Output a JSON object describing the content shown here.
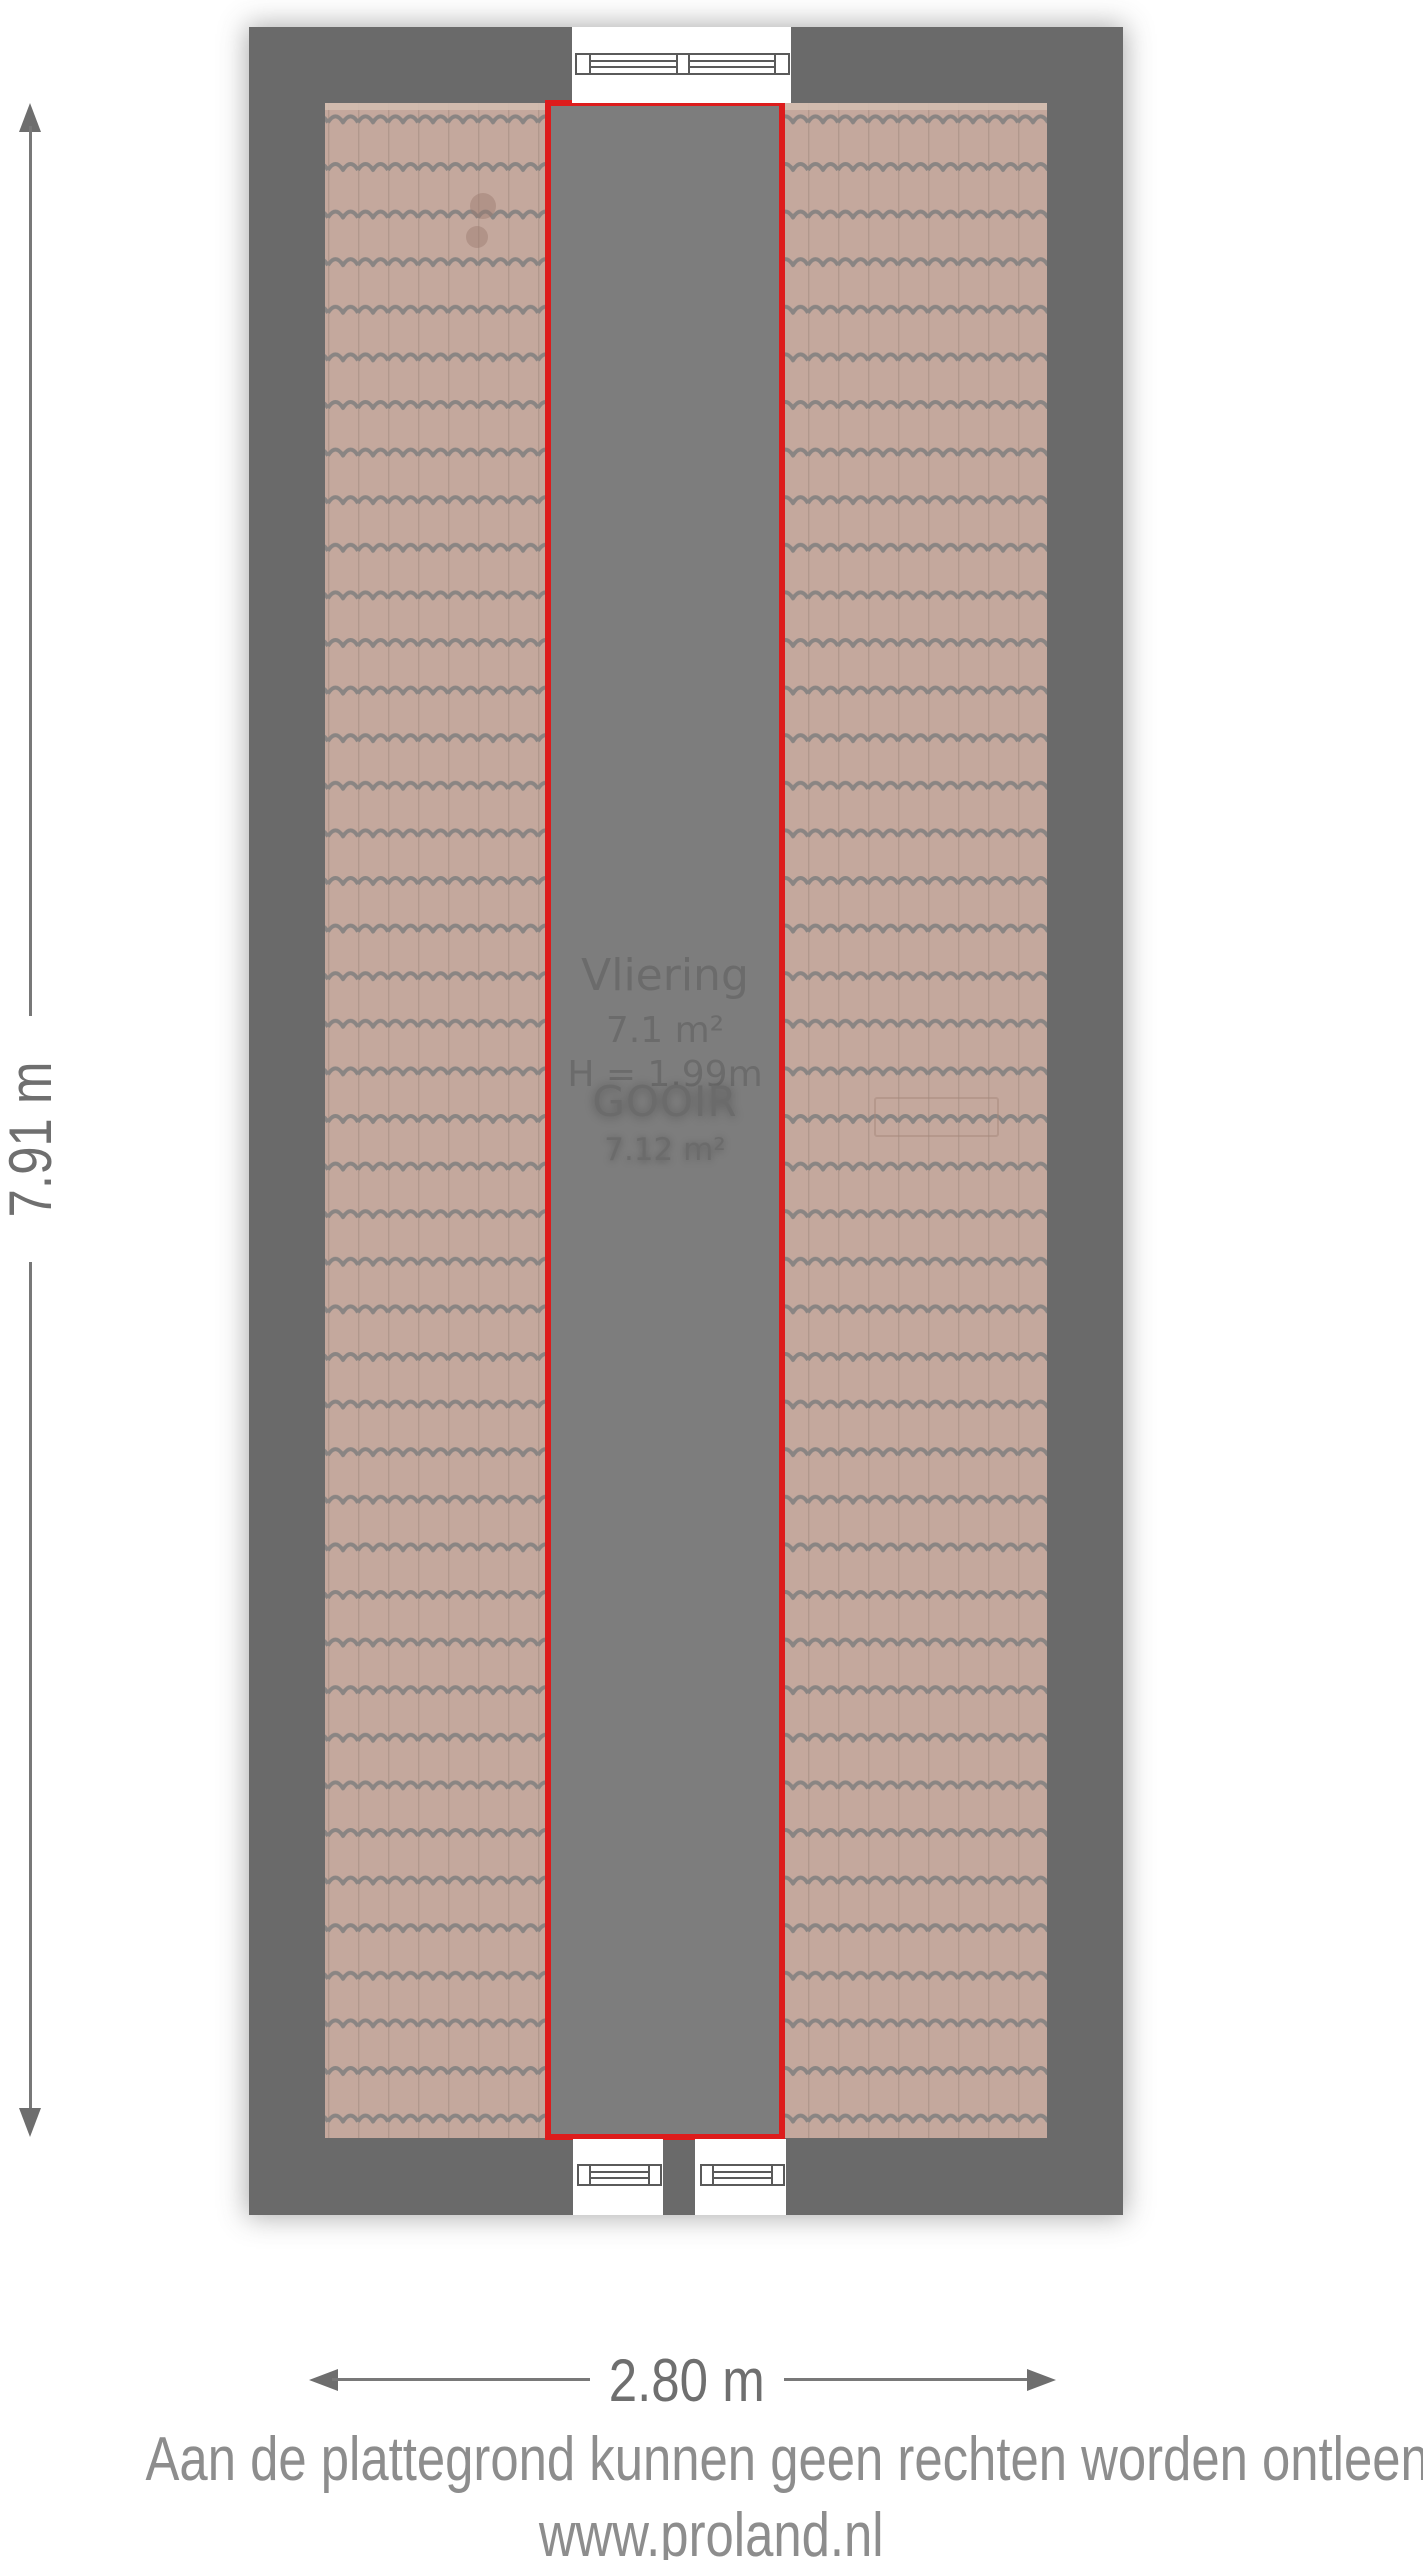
{
  "floorplan": {
    "room": {
      "name": "Vliering",
      "area": "7.1 m²",
      "height": "H = 1.99m"
    },
    "selection": {
      "label": "GOOIR",
      "area": "7.12 m²"
    },
    "dimensions": {
      "height_label": "7.91 m",
      "width_label": "2.80 m"
    },
    "colors": {
      "page_bg": "#ffffff",
      "wall": "#6a6a6a",
      "room_fill": "#7d7d7d",
      "room_text": "#6b6b6b",
      "selection_border": "#dd1c1c",
      "selection_text": "#ffffff",
      "tile_base": "#c4a89d",
      "tile_line": "#8a8583",
      "dimension_line": "#787878",
      "dimension_arrow": "#6e6e6e",
      "dimension_text": "#6f6f6f",
      "footer_text": "#8d8d8d"
    }
  },
  "footer": {
    "disclaimer": "Aan de plattegrond kunnen geen rechten worden ontleend.",
    "website": "www.proland.nl"
  }
}
